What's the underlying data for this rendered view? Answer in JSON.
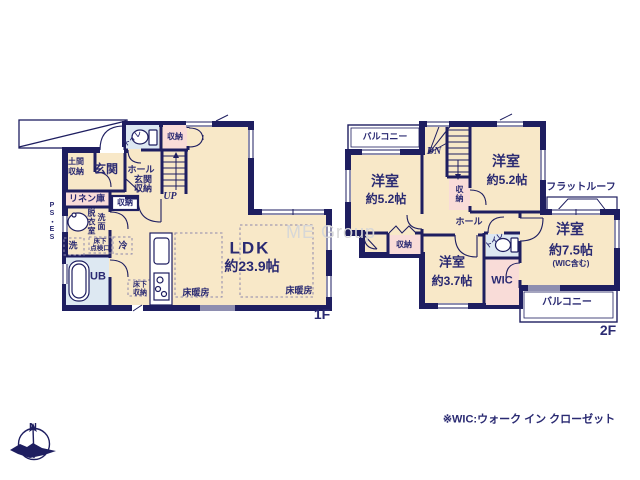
{
  "watermark": "ME Group",
  "note": "※WIC:ウォーク イン クローゼット",
  "compass_n": "N",
  "floor1": {
    "floor_tag": "1F",
    "ldk": "LDK",
    "ldk_size": "約23.9帖",
    "genkan": "玄関",
    "doma_1": "土間",
    "doma_2": "収納",
    "toilet": "トイレ",
    "closet_top": "収納",
    "hall_1": "ホール",
    "hall_2": "玄関",
    "hall_3": "収納",
    "up": "UP",
    "linen": "リネン庫",
    "closet_small": "収納",
    "datsui": "脱衣室",
    "senmen": "洗面",
    "ps": "PS・ES",
    "laundry": "洗",
    "inspection_1": "床下",
    "inspection_2": "点検口",
    "fridge": "冷",
    "ub": "UB",
    "underfloor_1": "床下",
    "underfloor_2": "収納",
    "heating_left": "床暖房",
    "heating_right": "床暖房"
  },
  "floor2": {
    "floor_tag": "2F",
    "balcony_tl": "バルコニー",
    "room_left": "洋室",
    "room_left_size": "約5.2帖",
    "dn": "DN",
    "closet_stairs": "収納",
    "room_tr": "洋室",
    "room_tr_size": "約5.2帖",
    "flat_roof": "フラットルーフ",
    "hall": "ホール",
    "closet_left": "収納",
    "room_small": "洋室",
    "room_small_size": "約3.7帖",
    "toilet": "トイレ",
    "wic": "WIC",
    "room_main": "洋室",
    "room_main_size": "約7.5帖",
    "room_main_note": "(WIC含む)",
    "balcony_br": "バルコニー"
  }
}
